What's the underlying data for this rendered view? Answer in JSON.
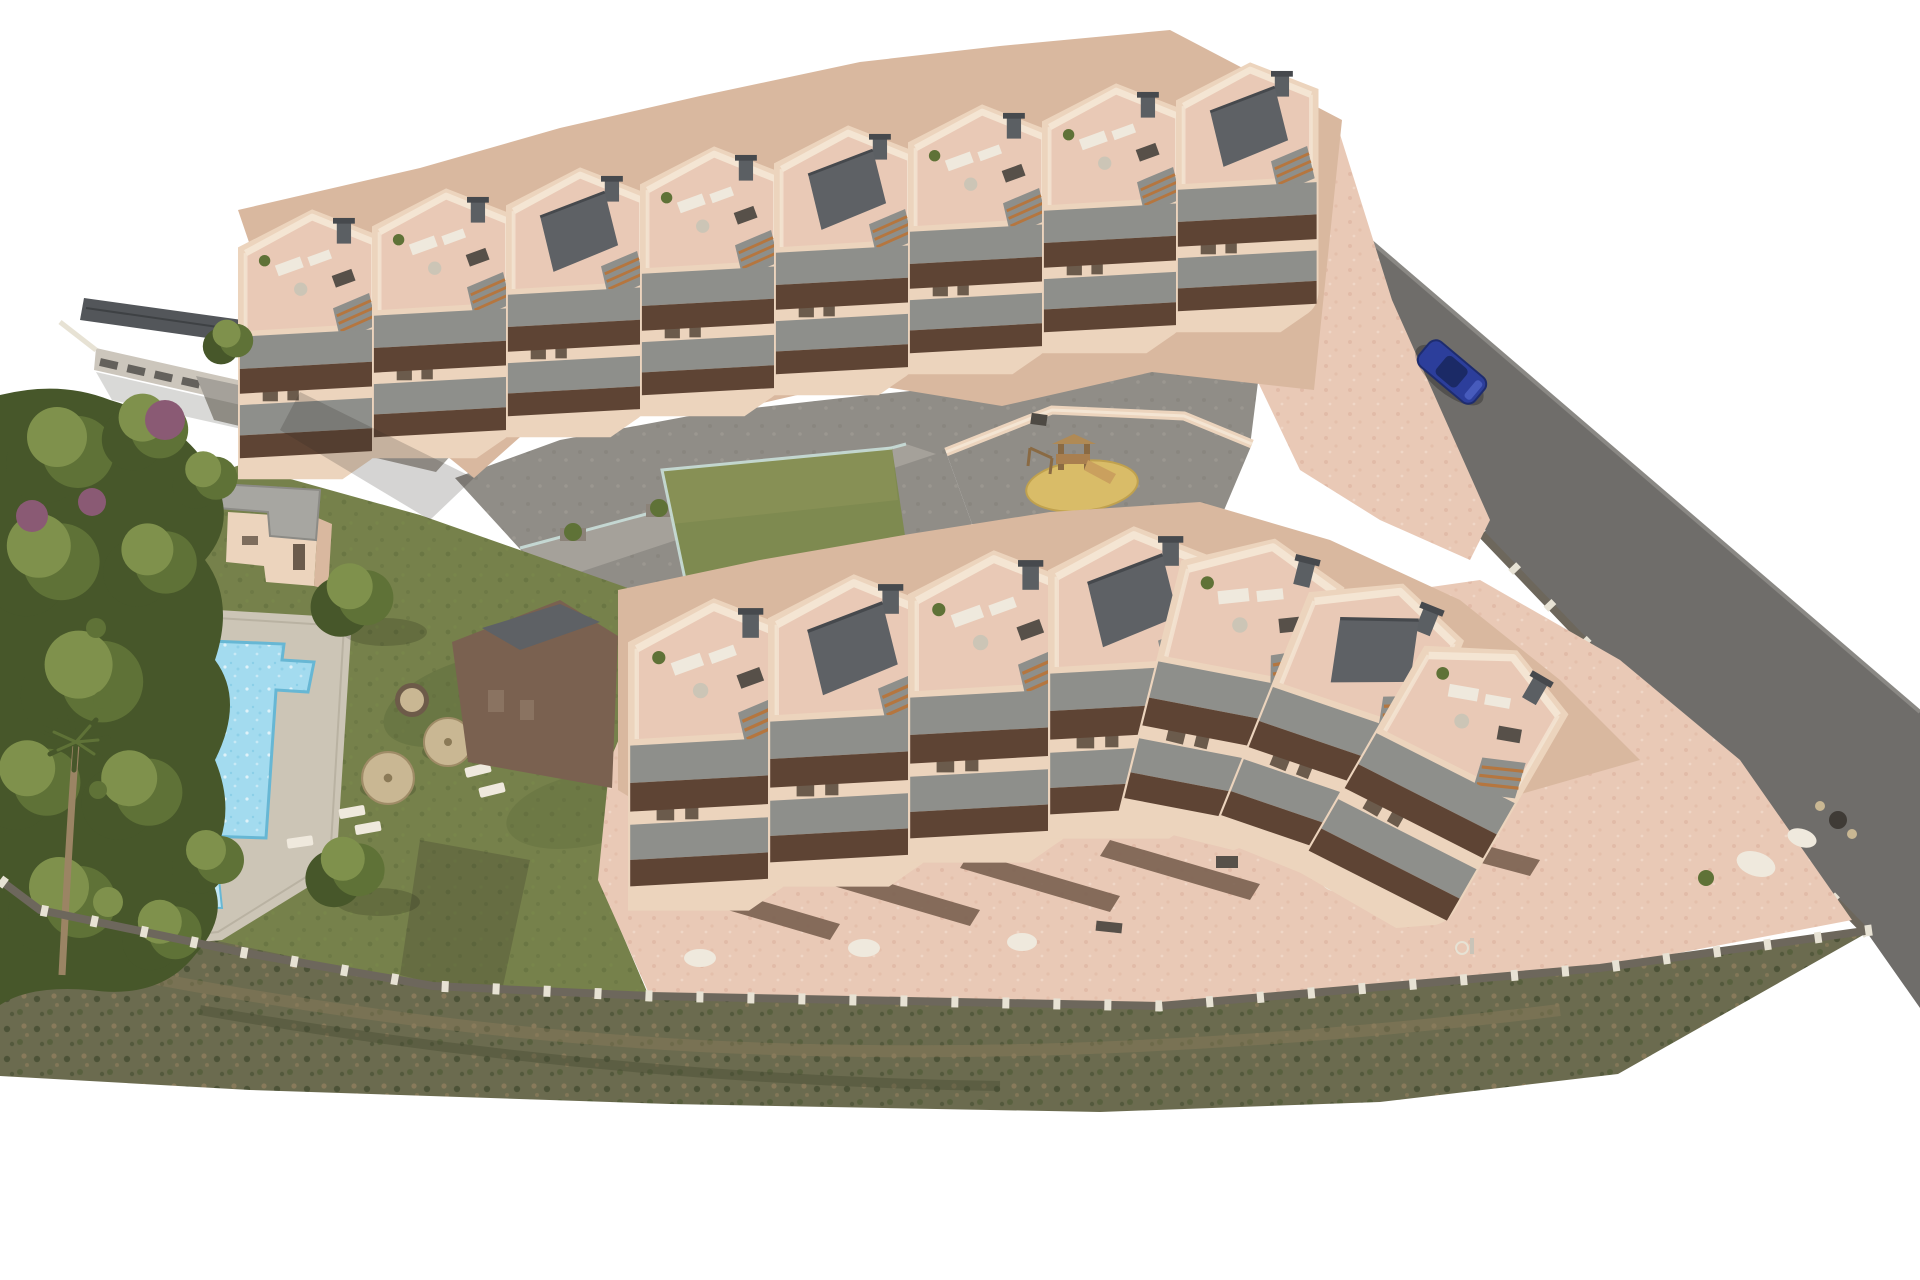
{
  "scene": {
    "kind": "3d-aerial-architectural-render",
    "subject": "terraced residential apartment complex with communal pool, lawn garden, playground and perimeter road",
    "background": "#ffffff"
  },
  "colors": {
    "bg": "#ffffff",
    "wall_light": "#ecd4bd",
    "wall_mid": "#d9b89f",
    "wall_dark": "#7a6150",
    "terrace_pink": "#e9c9b6",
    "terrace_mottle": "#d8ab97",
    "parapet_cream": "#f4e5d3",
    "parapet_gray": "#8e8f8b",
    "balcony_shadow": "#5e4434",
    "slate_roof": "#5e6165",
    "chimney": "#5b5f63",
    "chimney_cap": "#46494d",
    "window_dark": "#6b5b4c",
    "road": "#6f6d6a",
    "road_edge": "#8a8884",
    "paving": "#908d87",
    "paving_dark": "#7a7770",
    "paving_light": "#a5a19a",
    "deck": "#ccc5b6",
    "pool_water": "#a3dbef",
    "pool_water_deep": "#7cc6e2",
    "pool_edge": "#67b7d4",
    "pool_kids": "#c2e7f4",
    "lawn": "#76814b",
    "lawn_dark": "#5e6b3b",
    "tree_green": "#5f7237",
    "tree_dark": "#47572a",
    "tree_light": "#7f914c",
    "purple_bush": "#8a5a74",
    "scrub_base": "#6b6b4f",
    "scrub_dark": "#454c31",
    "scrub_green": "#57603c",
    "scrub_brown": "#8c7c5c",
    "sand": "#d9bc68",
    "sand_edge": "#c0a14e",
    "fence_light": "#e7e2d4",
    "fence_dark": "#6d675c",
    "glass": "#c9ded9",
    "umbrella": "#c9b793",
    "wood": "#a97f4f",
    "wood_step": "#b5763f",
    "car_blue": "#2c3e9b",
    "car_glass": "#1b2a66",
    "white_furniture": "#efe9dd",
    "dark_furniture": "#575049",
    "neighbor_roof": "#53565a",
    "neighbor_wall": "#ccc6bc",
    "pool_house_roof": "#a7a6a1"
  },
  "elements": {
    "building_rows": 2,
    "apartment_modules_upper_row": 8,
    "apartment_modules_lower_row": 7,
    "pools_main": 1,
    "pools_kids": 1,
    "parasols": 2,
    "playgrounds": 1,
    "lawn_courts": 1,
    "pool_houses": 1,
    "parked_cars": 1,
    "car_color_name": "blue"
  },
  "features": [
    "apartment-row-upper",
    "apartment-row-lower",
    "communal-pool",
    "kids-pool",
    "pool-deck",
    "lawn",
    "parasols",
    "sun-loungers",
    "pool-house",
    "lawn-court",
    "playground-sand-pit",
    "play-structure",
    "central-plaza",
    "perimeter-road",
    "stone-perimeter-fence",
    "scrubland-slope",
    "tree-cluster",
    "palm-tree",
    "parked-car",
    "neighbor-building"
  ]
}
